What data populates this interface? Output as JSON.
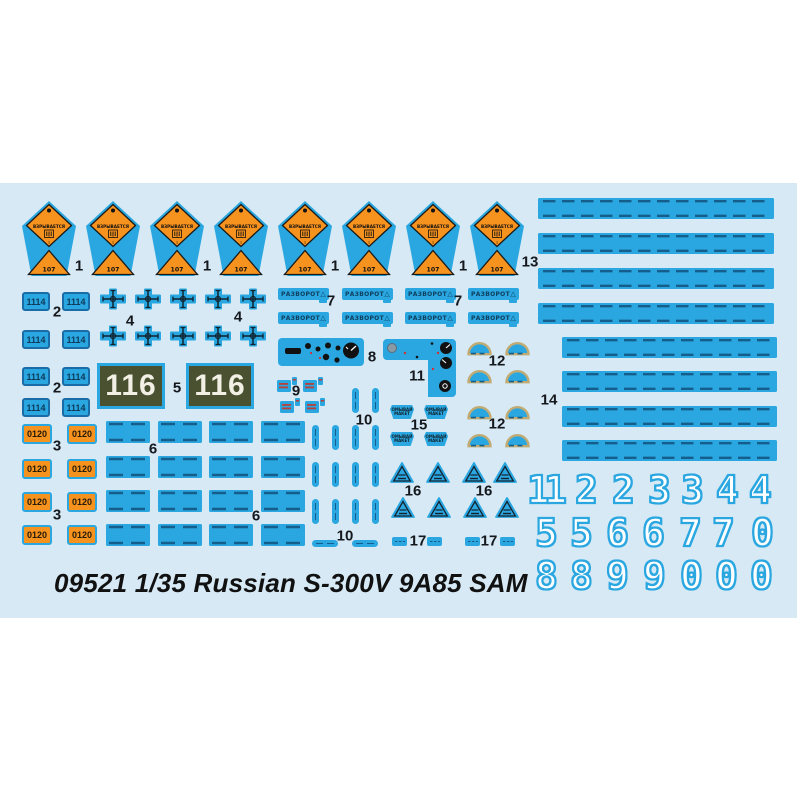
{
  "title": "09521 1/35 Russian S-300V 9A85 SAM",
  "colors": {
    "sheet_bg": "#d6e9f5",
    "decal_blue": "#2aa7e0",
    "dash_dark": "#155e8c",
    "orange": "#f6921e",
    "olive": "#4a5130",
    "tan": "#c2ab72",
    "red_stripe": "#b5413a",
    "ink": "#15181c"
  },
  "parts": [
    {
      "id": "warning-pentagon",
      "label": "1",
      "diamond_text": "ВЗРЫВАЕТСЯ",
      "diamond_digit": "1",
      "triangle_text": "107"
    },
    {
      "id": "plate-1114",
      "label": "2",
      "text": "1114"
    },
    {
      "id": "plate-0120",
      "label": "3",
      "text": "0120"
    },
    {
      "id": "cross",
      "label": "4"
    },
    {
      "id": "plate-116",
      "label": "5",
      "text": "116"
    },
    {
      "id": "dash-panel",
      "label": "6"
    },
    {
      "id": "razvorot",
      "label": "7",
      "text": "РАЗВОРОТ",
      "symbol": "△"
    },
    {
      "id": "instrument-panel",
      "label": "8"
    },
    {
      "id": "stripe-tag",
      "label": "9"
    },
    {
      "id": "dash-bar",
      "label": "10"
    },
    {
      "id": "l-panel",
      "label": "11"
    },
    {
      "id": "semicircle",
      "label": "12"
    },
    {
      "id": "long-strip",
      "label": "13"
    },
    {
      "id": "medium-strip",
      "label": "14"
    },
    {
      "id": "trapezoid-label",
      "label": "15",
      "lines": [
        "ОМЫВАЙ",
        "МАКЕТ"
      ]
    },
    {
      "id": "warning-triangle",
      "label": "16"
    },
    {
      "id": "small-label",
      "label": "17"
    }
  ],
  "stencil_rows": [
    [
      "1",
      "1",
      "2",
      "2",
      "3",
      "3",
      "4",
      "4"
    ],
    [
      "5",
      "5",
      "6",
      "6",
      "7",
      "7",
      "0"
    ],
    [
      "8",
      "8",
      "9",
      "9",
      "0",
      "0",
      "0"
    ]
  ]
}
